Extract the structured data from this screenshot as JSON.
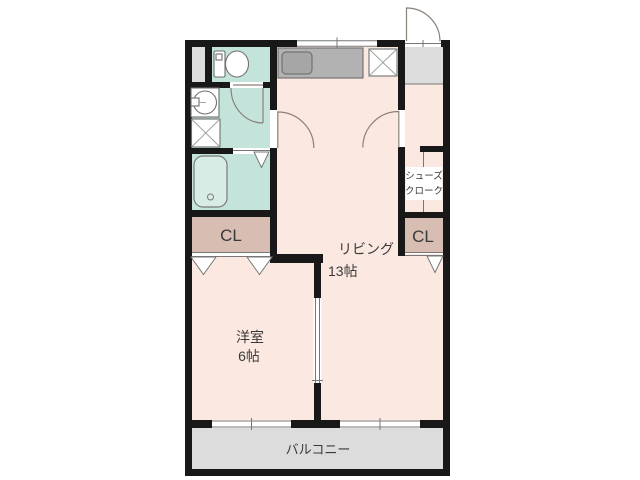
{
  "meta": {
    "type": "apartment-floor-plan"
  },
  "colors": {
    "wall": "#181818",
    "room": "#fbe9e1",
    "wet_area": "#c3e3db",
    "closet": "#d7bdb2",
    "outdoor": "#dcdcdc",
    "counter": "#b2b2b2",
    "counter_sink": "#a6a6a6",
    "bathtub": "#d6ece5",
    "door_line": "#8a8178"
  },
  "rooms": {
    "living": {
      "label": "リビング",
      "size": "13帖"
    },
    "western": {
      "label": "洋室",
      "size": "6帖"
    },
    "closet_left": {
      "label": "CL"
    },
    "closet_right": {
      "label": "CL"
    },
    "shoe_closet": {
      "line1": "シューズ",
      "line2": "クローク"
    },
    "balcony": {
      "label": "バルコニー"
    }
  },
  "fixtures": {
    "toilet": "toilet",
    "washbasin": "washbasin",
    "washer_pan": "washing-machine-pan",
    "bathtub": "bathtub",
    "kitchen_counter": "kitchen-counter",
    "kitchen_sink": "kitchen-sink",
    "refrigerator": "refrigerator-space"
  }
}
